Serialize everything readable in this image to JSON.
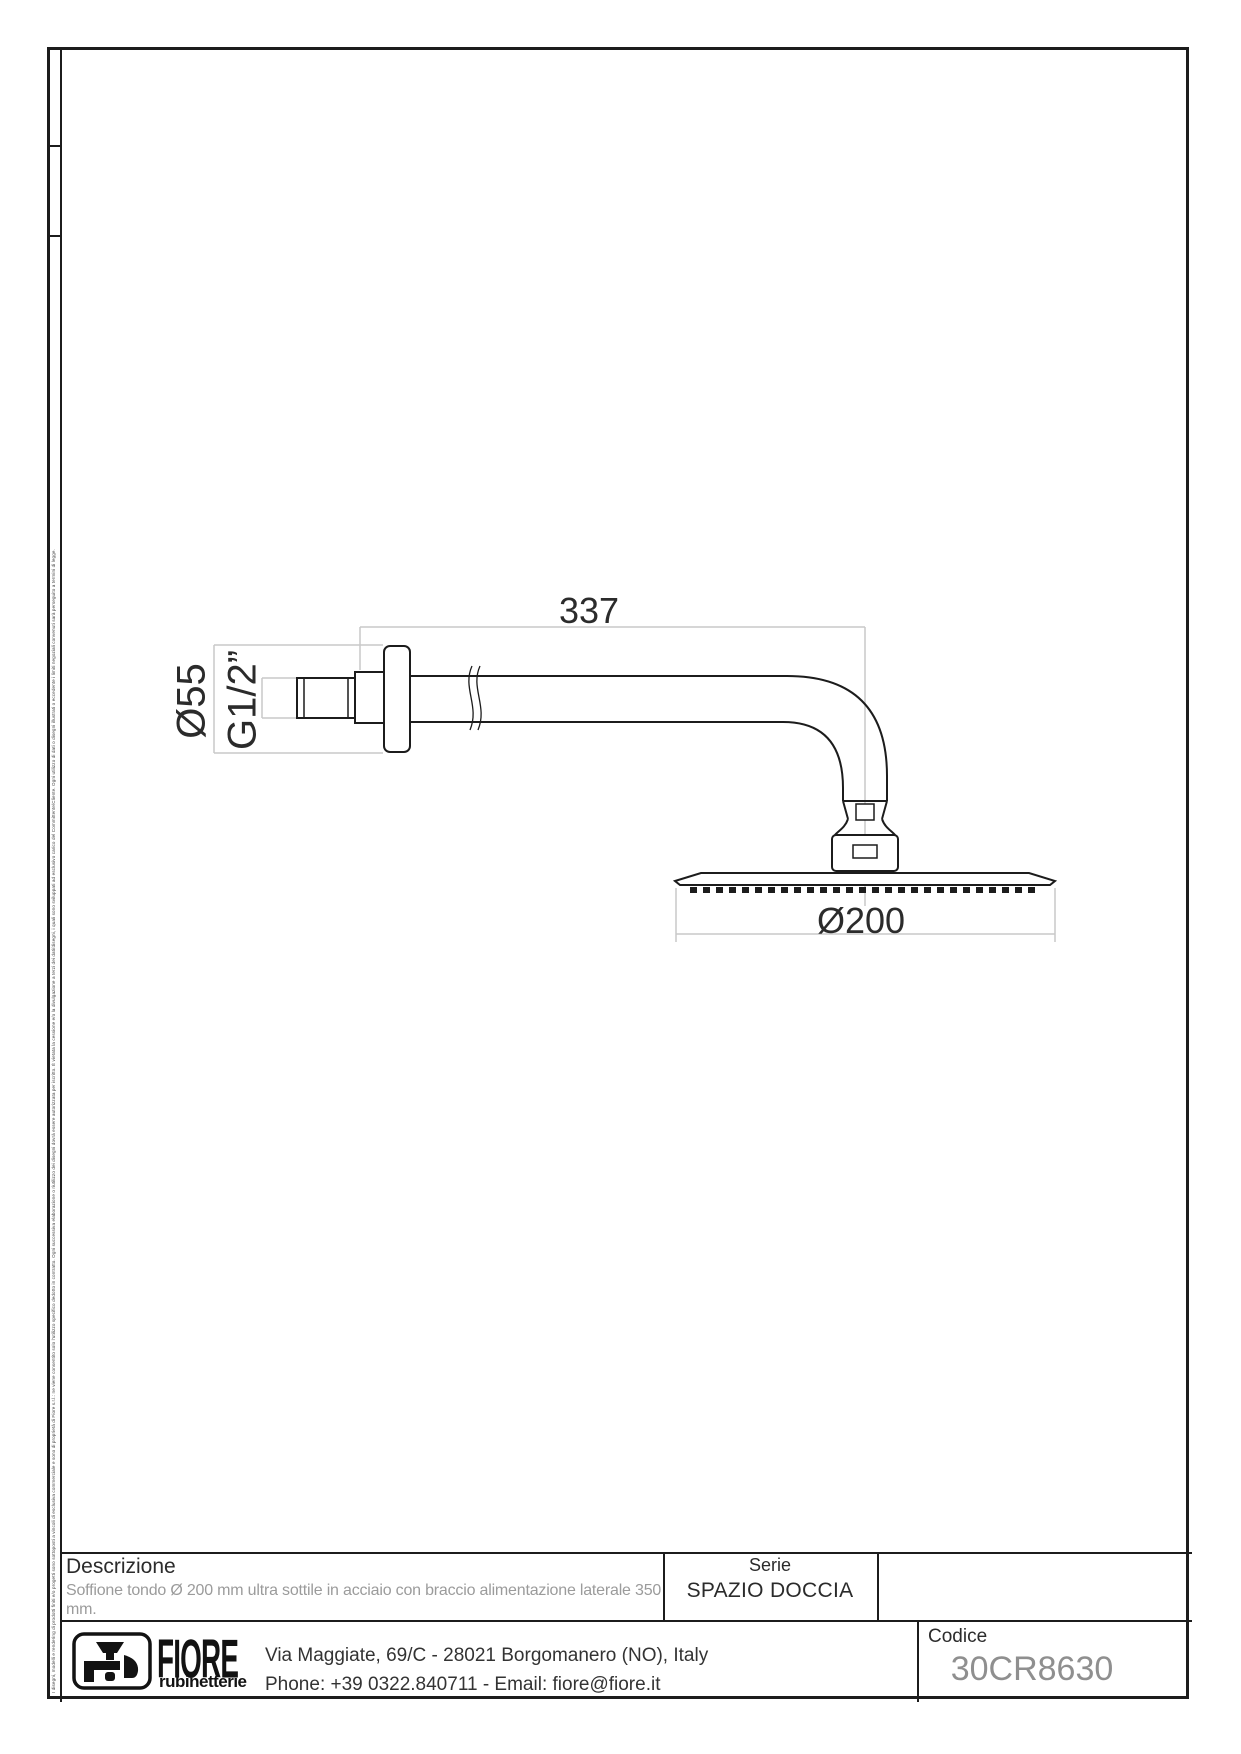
{
  "drawing": {
    "dims": {
      "arm_length": "337",
      "flange_diameter": "Ø55",
      "thread_size": "G1/2”",
      "head_diameter": "Ø200"
    }
  },
  "side_note": "I disegni, modelli e rendering di prodotti finiti e/o progetti sono sottoposti a vincoli di esclusiva commerciale e sono di proprietà di Fiore s.r.l.: ne viene consentito solo l'utilizzo specifico dedotto in contratto. Ogni successiva elaborazione o riutilizzo dei disegni dovrà essere autorizzata per iscritto. È vietata la cessione e/o la divulgazione a terzi dei dati/disegni, i quali sono sviluppati ad esclusivo carico del Committente/Cliente. Ogni utilizzo di dati o disegni illustrati o eccedente i limiti negoziali convenuti sarà perseguito a termini di legge.",
  "title_block": {
    "description": {
      "label": "Descrizione",
      "lines": [
        "Soffione tondo Ø 200 mm ultra sottile in acciaio con braccio alimentazione laterale 350",
        "mm."
      ]
    },
    "series": {
      "label": "Serie",
      "value": "SPAZIO DOCCIA"
    },
    "code": {
      "label": "Codice",
      "value": "30CR8630"
    },
    "manufacturer": {
      "name": "FIORE",
      "subname": "rubinetterie",
      "address": "Via Maggiate, 69/C - 28021 Borgomanero (NO), Italy",
      "contact": "Phone: +39 0322.840711 - Email: fiore@fiore.it"
    }
  },
  "colors": {
    "line": "#1c1c1c",
    "dim_line": "#c9c9c9",
    "muted_text": "#9b9b9b",
    "code_text": "#8f8f8f"
  }
}
